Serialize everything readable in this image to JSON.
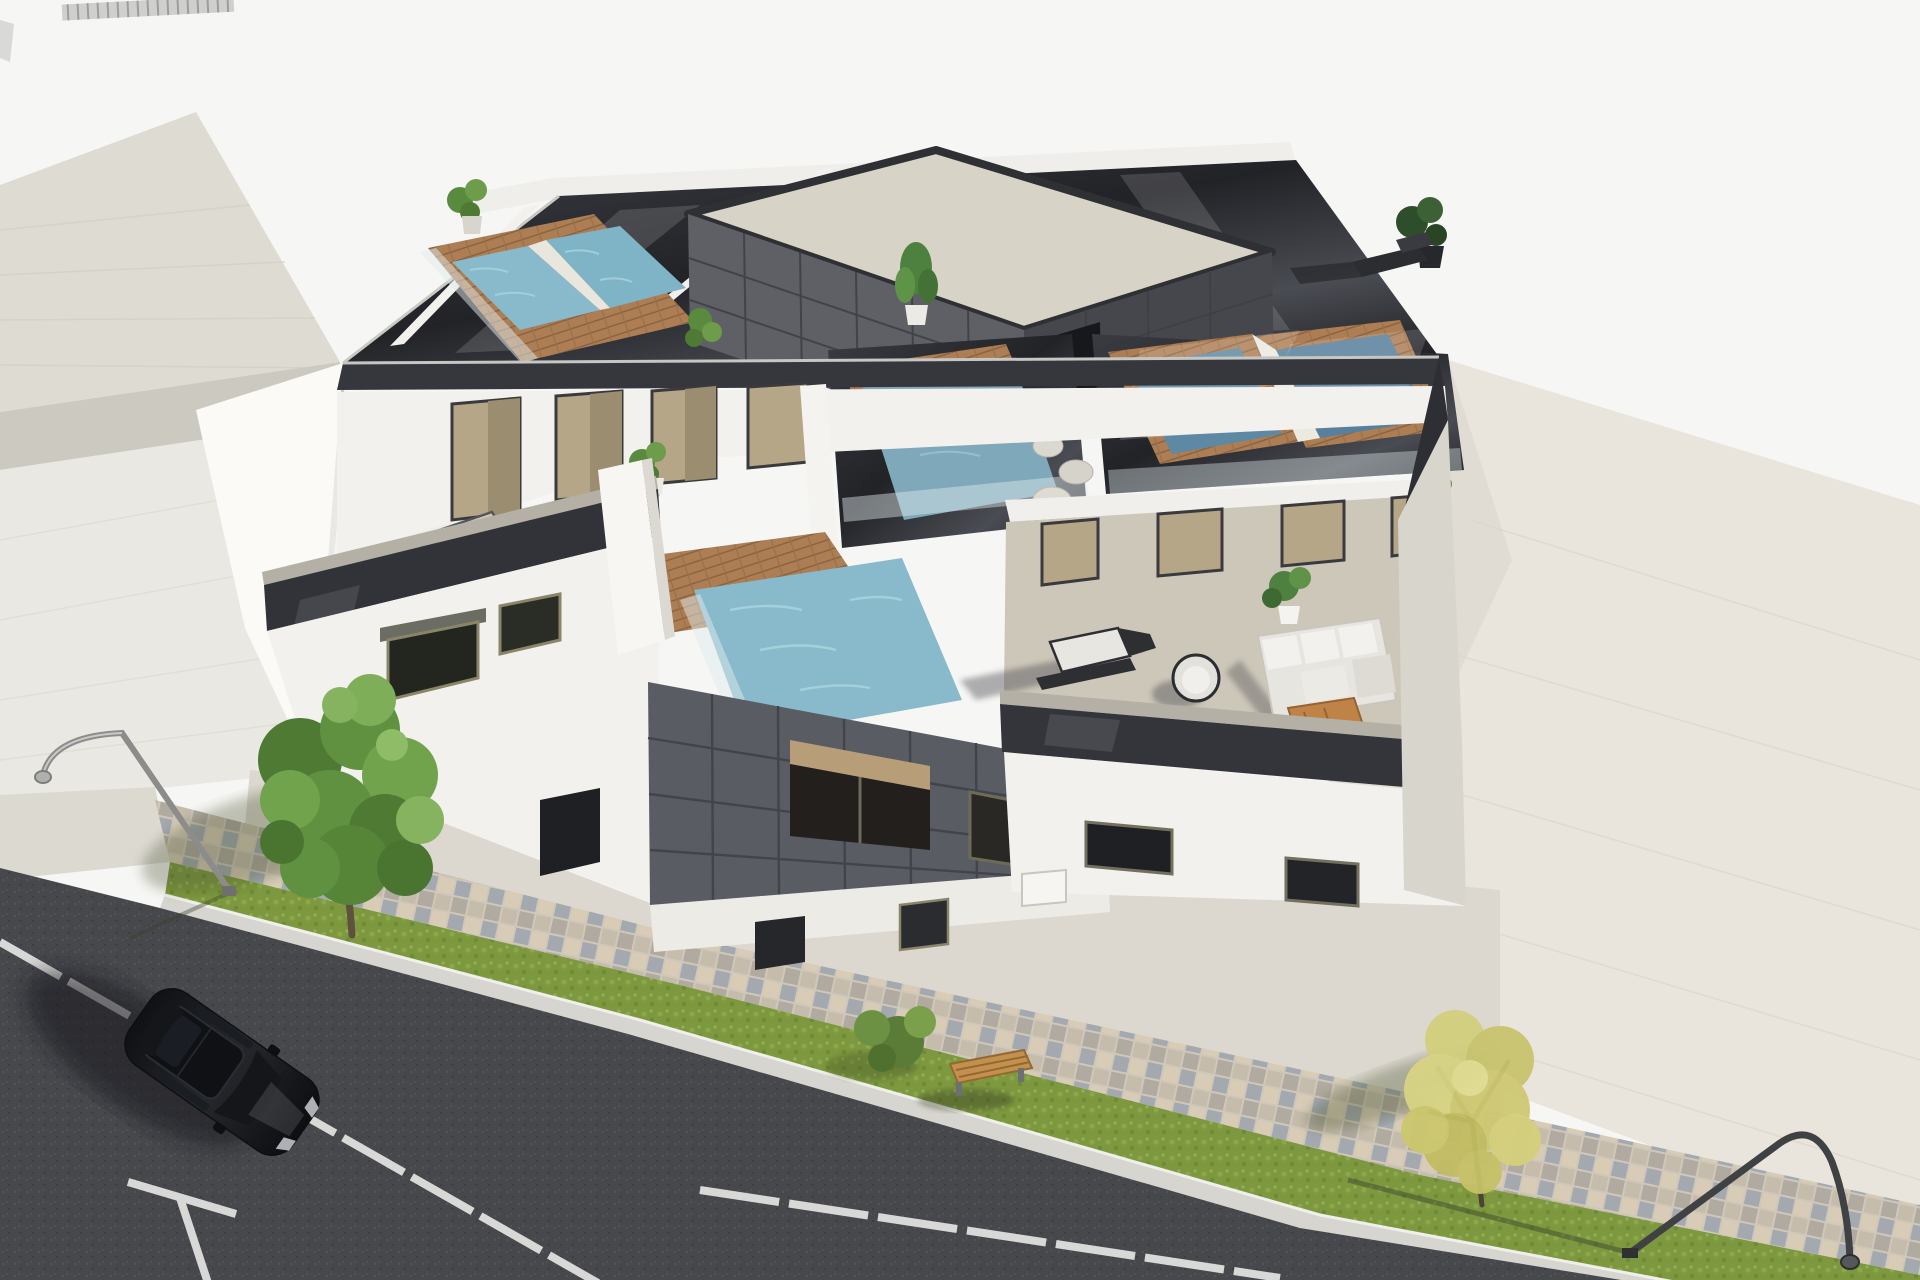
{
  "scene": {
    "type": "3d-architectural-rendering",
    "description": "High-angle aerial 3D rendering of a modern three-storey white residential building with five rooftop plunge pools framed in wood with glass balustrades, a dark tiled rooftop stair tower with beige cap, furnished first-floor terraces (sun loungers, white corner sofa, wooden coffee table, potted plants), a dark grey tiled feature wall with recessed windows, a mosaic paver sidewalk, lawn strip with bench and shrub, asphalt street with white parking markings and a parked black car, two curved street lamps, one green tree, one yellow autumn tree, a neighbouring light building on the left and an empty beige lot on the right."
  },
  "palette": {
    "background": "#f6f6f4",
    "neighbor_roof": "#dedbd3",
    "neighbor_fascia": "#ccc9c0",
    "neighbor_wall": "#eae8e2",
    "vacant_lot": "#e9e5dc",
    "asphalt": "#47484c",
    "grass": "#7d983e",
    "paver_base": "#cfc8ba",
    "building_white": "#f2f1ed",
    "west_wall_white": "#fbfaf7",
    "facade_dark": "#36373c",
    "deck_dark": "#26272c",
    "tile_wall": "#5a5c63",
    "stair_cap": "#d7d3c6",
    "terrace_floor": "#cdc7b9",
    "wood_coping": "#ad7e54",
    "pool_water_light": "#88bacc",
    "pool_water_dark": "#5d89a4",
    "door_glass": "#b5a687",
    "tree_green": "#5f9140",
    "tree_yellow": "#cdc873",
    "car_body": "#17181b",
    "road_marking": "#e8e8e6"
  },
  "objects": {
    "buildings": [
      "new-apartment-building",
      "neighbor-building"
    ],
    "rooftop_pools": 5,
    "terrace_pools": 1,
    "street_lamps": 2,
    "trees": [
      "green-tree",
      "yellow-autumn-tree"
    ],
    "vehicles": [
      "black-suv"
    ],
    "street_furniture": [
      "wooden-bench"
    ],
    "terrace_furniture": [
      "sun-loungers",
      "corner-sofa",
      "coffee-table",
      "round-chair",
      "poufs",
      "potted-plants"
    ]
  }
}
